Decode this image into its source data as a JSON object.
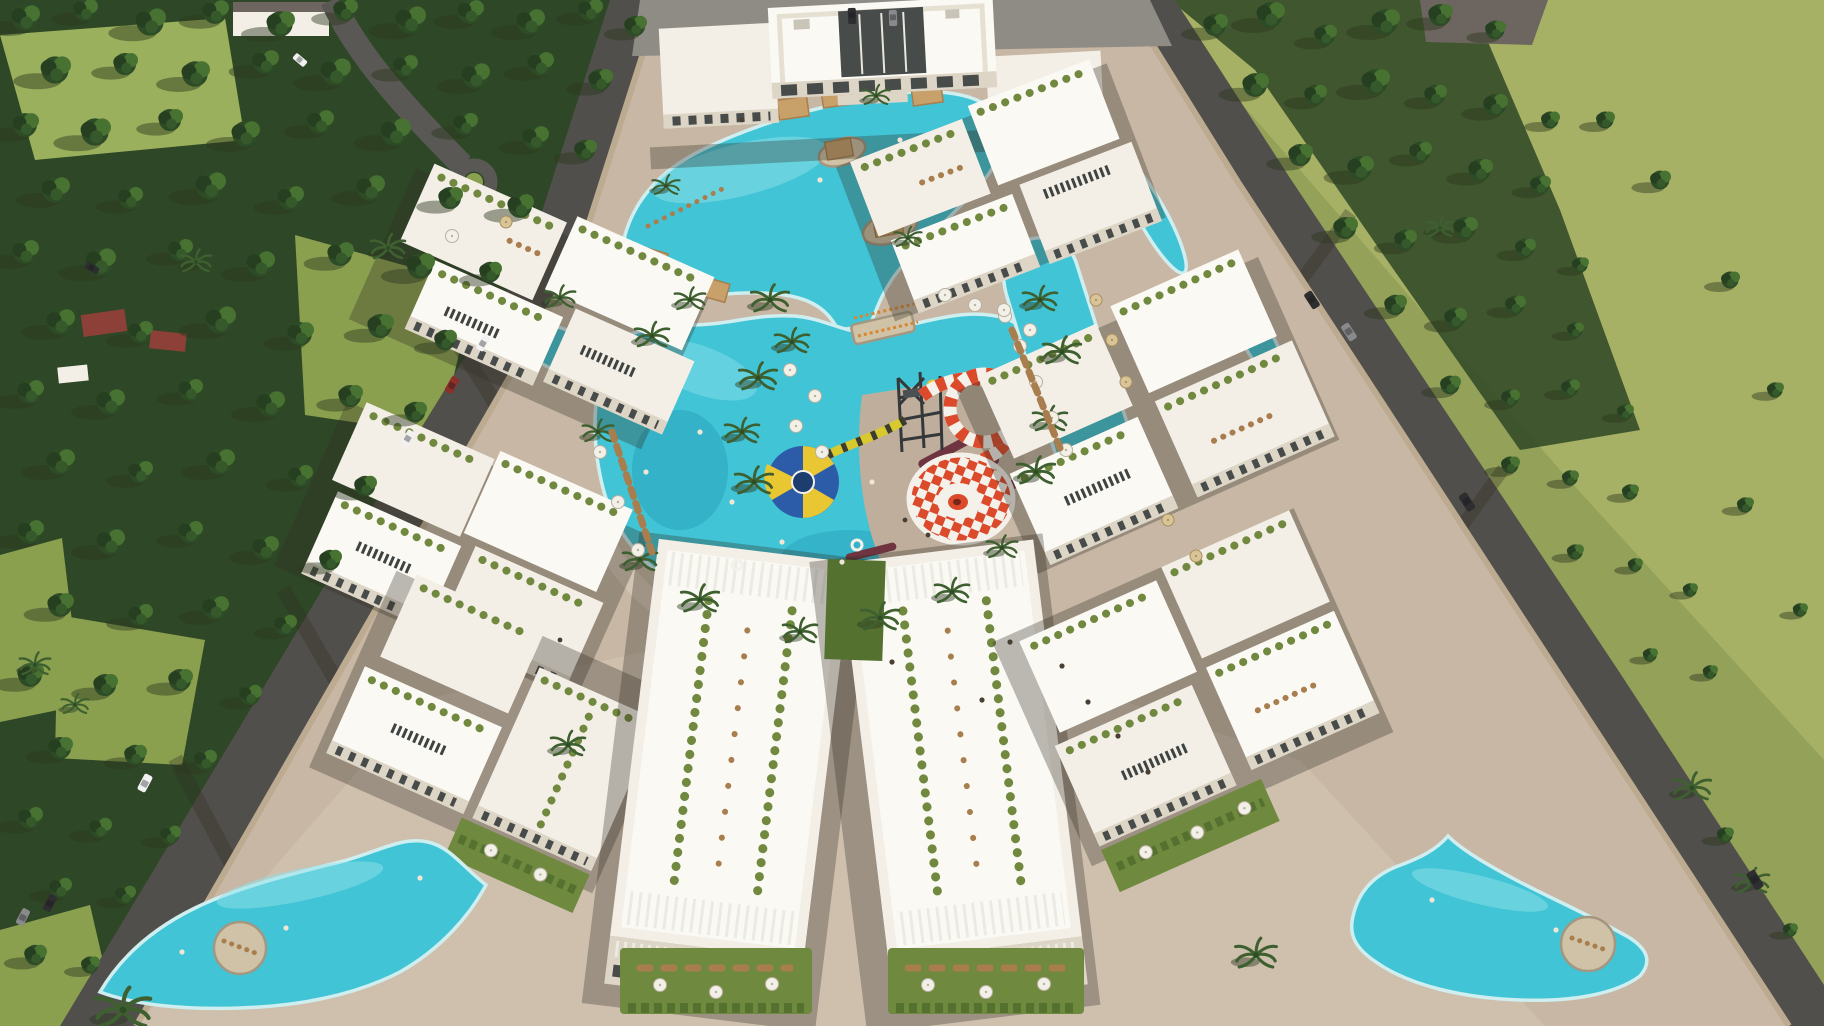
{
  "meta": {
    "title": "Resort masterplan aerial rendering",
    "description": "Aerial 3D architectural rendering of a gated resort residential complex: white low-rise apartment clusters with rooftop garden terraces arranged around a turquoise swimming lagoon and waterpark with red-and-white checkered funnel slide, blue funnel slide and slide tower; clubhouse with cabana-lined pool at top; two free-form pools with circular islands on the front plaza; perimeter roads with cars, stone boundary walls, dense pine forest on the left and olive-green open fields with scattered trees on the right.",
    "render_type": "architectural-render",
    "visible_text": "none"
  },
  "objects": {
    "clubhouse": "clubhouse with glass atrium",
    "upper_lagoon": "cabana pool lagoon",
    "lower_lagoon": "waterpark lagoon",
    "funnel_red": "red-white checkered funnel slide",
    "funnel_blue": "blue-yellow funnel slide",
    "tower": "slide tower",
    "bridge": "wooden footbridge",
    "left_pool": "front plaza pool west",
    "right_pool": "front plaza pool east",
    "clusters": "apartment clusters with roof terraces",
    "forest": "pine forest",
    "field": "open green field",
    "roads": "perimeter roads with cars"
  },
  "colors": {
    "field": "#94a159",
    "fieldLight": "#a6b165",
    "lawn": "#8aa04f",
    "lawnLight": "#9ab05c",
    "forestBase": "#2e4726",
    "pine1": "#2d4b26",
    "pine2": "#477231",
    "pine3": "#253f20",
    "pine4": "#36592b",
    "treeShadow": "rgba(45,55,30,0.45)",
    "road": "#514f4b",
    "paving": "#c8b7a4",
    "pavingLight": "#d6c8b6",
    "pavingDeck": "#bfae9b",
    "parking": "#8f8c85",
    "wall": "#bcab90",
    "pool": "#41c4d5",
    "poolLight": "#8fe2ea",
    "poolDeep": "#2aa4bd",
    "poolRim": "#cfeef0",
    "bldg": "#f3efe7",
    "bldgBright": "#fbf9f4",
    "bldgShade": "#ddd5c6",
    "bldgDark": "#b9b0a2",
    "window": "#474b4a",
    "roofGarden": "#71883f",
    "hedge": "#55712f",
    "garden": "#6f8a3e",
    "slat": "#ecebe3",
    "skylight": "#3f4442",
    "furniture": "#a97e4e",
    "canopy": "#c8a06a",
    "canopyShade": "#a87f4f",
    "slideRed": "#dc4a2c",
    "slideWhite": "#f4f1ea",
    "funnelBlue": "#2c5ca8",
    "funnelYellow": "#e9c733",
    "funnelNavy": "#1d3d6e",
    "tubeYellow": "#d8c92f",
    "tubeDark": "#3c3c30",
    "slideMaroon": "#6e3440",
    "umbrella": "#f3f0e8",
    "umbrellaEdge": "#b8b0a0",
    "umbrellaTan": "#d9c498",
    "island": "#cfc2a6",
    "islandRim": "#a39781",
    "carDark": "#2e2e30",
    "carGray": "#8a8a8c",
    "carWhite": "#f2f2f2",
    "carRed": "#8e2f2a",
    "flower": "#c06a8a",
    "people": "#4a3f33",
    "shadow": "rgba(50,46,36,0.32)",
    "shadowSoft": "rgba(50,46,36,0.16)",
    "estateRoof": "#6d655f",
    "houseRoof": "#8d4038",
    "bridgeOrange": "#d8862f"
  }
}
